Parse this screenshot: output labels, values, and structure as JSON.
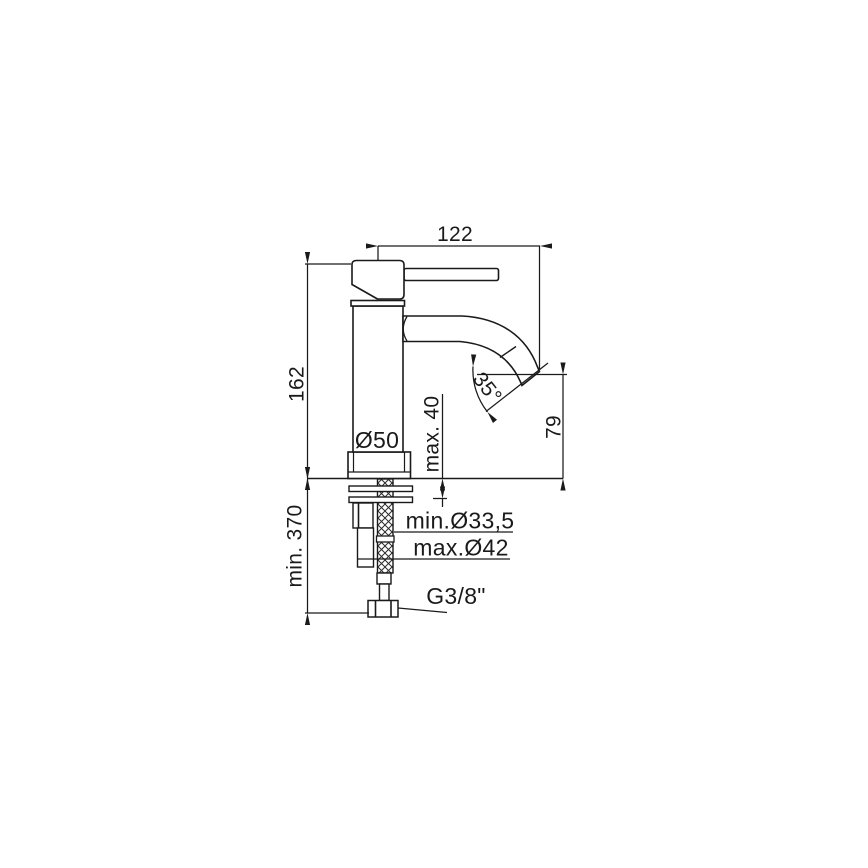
{
  "drawing": {
    "type": "technical installation drawing – single-lever basin mixer tap, side view",
    "dimensions": {
      "spout_reach": "122",
      "height": "162",
      "min_clearance_below": "min. 370",
      "max_deck_thickness": "max. 40",
      "outlet_height": "79",
      "outlet_angle": "35°",
      "base_diameter": "Ø50",
      "min_hole": "min.Ø33,5",
      "max_hole": "max.Ø42",
      "supply_thread": "G3/8\""
    },
    "colors": {
      "line": "#1a1a1a",
      "background": "#ffffff"
    }
  }
}
